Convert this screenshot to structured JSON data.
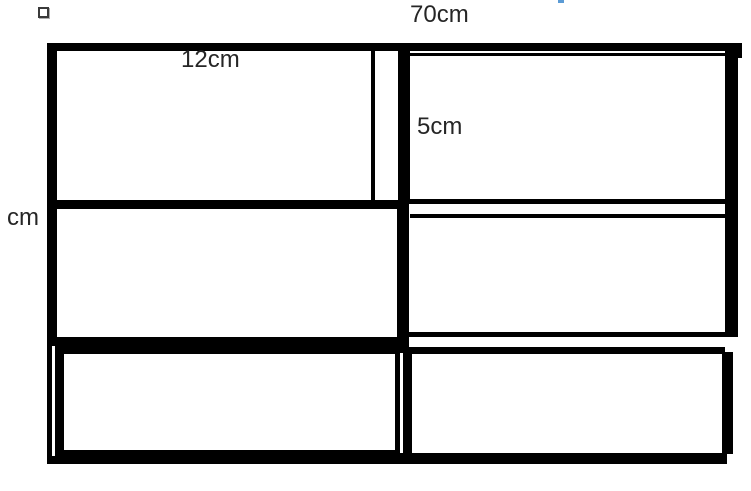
{
  "diagram": {
    "kind": "measured-rectangle-brick-wall-figure",
    "grid": {
      "columns": 2,
      "rows": 3
    },
    "labels": {
      "top_width": "70cm",
      "brick_width": "12cm",
      "brick_height": "5cm",
      "left_partial_unit": "cm"
    },
    "colors": {
      "line": "#000000",
      "text": "#262626",
      "background": "#ffffff",
      "cursor_fragment": "#5b9bd5"
    },
    "decorations": {
      "bullet": "empty-square-bullet",
      "cursor_fragment": "blue-dash-top-edge"
    }
  }
}
